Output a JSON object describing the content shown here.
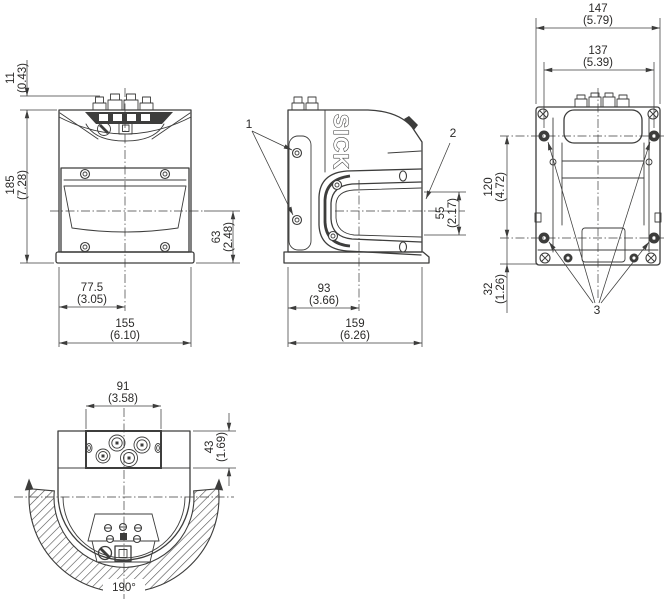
{
  "drawing": {
    "brand": "SICK",
    "views": {
      "front": {
        "dims": {
          "cap_height": {
            "mm": "11",
            "inch": "(0.43)"
          },
          "total_height": {
            "mm": "185",
            "inch": "(7.28)"
          },
          "window_to_bottom": {
            "mm": "63",
            "inch": "(2.48)"
          },
          "edge_to_center": {
            "mm": "77.5",
            "inch": "(3.05)"
          },
          "total_width": {
            "mm": "155",
            "inch": "(6.10)"
          }
        }
      },
      "side": {
        "callouts": {
          "fixing_screws": "1",
          "front_window": "2"
        },
        "dims": {
          "window_height": {
            "mm": "55",
            "inch": "(2.17)"
          },
          "rear_to_scan_axis": {
            "mm": "93",
            "inch": "(3.66)"
          },
          "total_depth": {
            "mm": "159",
            "inch": "(6.26)"
          }
        }
      },
      "rear": {
        "callouts": {
          "mounting_holes": "3"
        },
        "dims": {
          "overall_width": {
            "mm": "147",
            "inch": "(5.79)"
          },
          "hole_spacing_x": {
            "mm": "137",
            "inch": "(5.39)"
          },
          "hole_spacing_y": {
            "mm": "120",
            "inch": "(4.72)"
          },
          "hole_to_bottom": {
            "mm": "32",
            "inch": "(1.26)"
          }
        }
      },
      "top": {
        "dims": {
          "connector_width": {
            "mm": "91",
            "inch": "(3.58)"
          },
          "connector_depth": {
            "mm": "43",
            "inch": "(1.69)"
          },
          "scan_angle": {
            "value": "190°"
          }
        }
      }
    }
  }
}
